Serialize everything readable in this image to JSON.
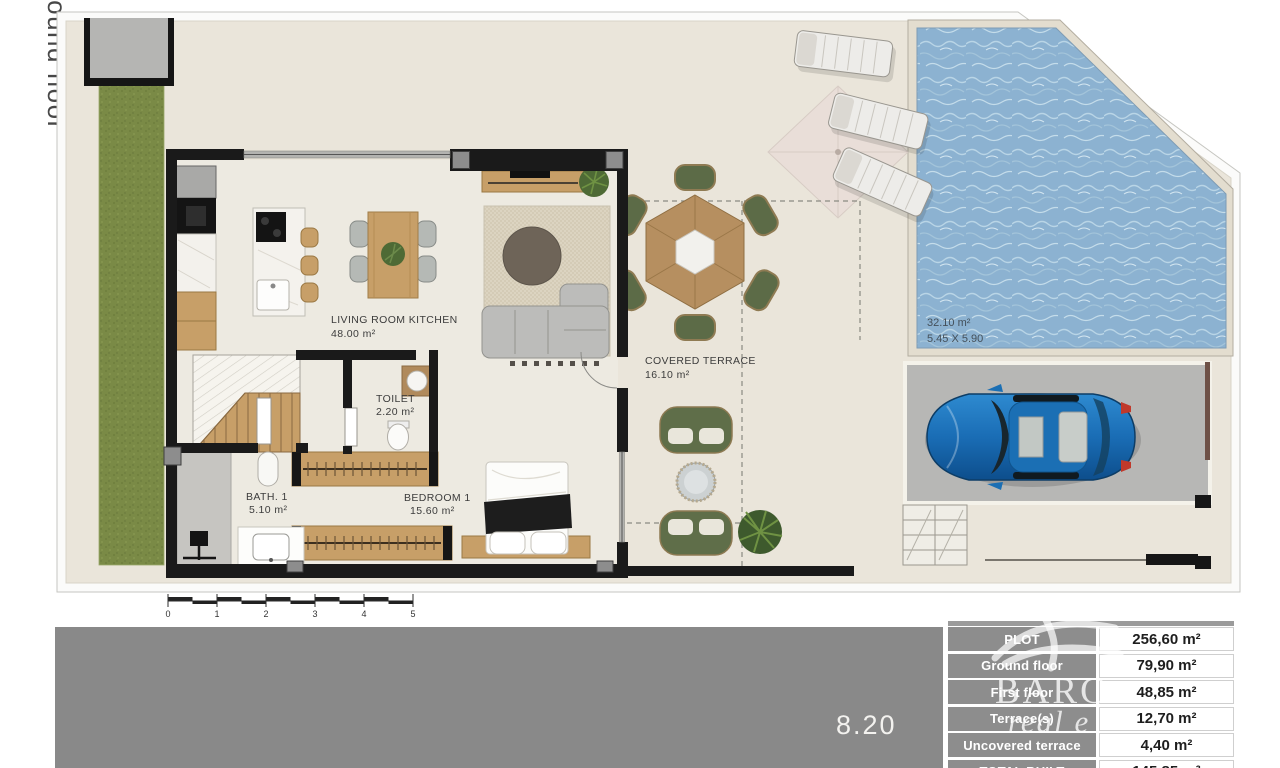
{
  "floor": {
    "label": "ground floor"
  },
  "plan_labels": {
    "living": {
      "name": "LIVING ROOM KITCHEN",
      "area": "48.00 m²"
    },
    "toilet": {
      "name": "TOILET",
      "area": "2.20 m²"
    },
    "bath": {
      "name": "BATH. 1",
      "area": "5.10 m²"
    },
    "bedroom": {
      "name": "BEDROOM 1",
      "area": "15.60 m²"
    },
    "covered_terrace": {
      "name": "COVERED TERRACE",
      "area": "16.10 m²"
    },
    "pool": {
      "area": "32.10 m²",
      "size": "5.45 X 5.90"
    }
  },
  "scale_bar": {
    "ticks": [
      "0",
      "1",
      "2",
      "3",
      "4",
      "5"
    ]
  },
  "dimension": {
    "plot_width": "8.20"
  },
  "areas_table": {
    "rows": [
      {
        "label": "PLOT",
        "value": "256,60 m²"
      },
      {
        "label": "Ground floor",
        "value": "79,90 m²"
      },
      {
        "label": "First floor",
        "value": "48,85 m²"
      },
      {
        "label": "Terrace(s)",
        "value": "12,70 m²"
      },
      {
        "label": "Uncovered terrace",
        "value": "4,40 m²"
      },
      {
        "label": "TOTAL BUILT",
        "value": "145,85 m²"
      }
    ]
  },
  "watermark": {
    "line1": "BARC",
    "line2": "real e"
  },
  "colors": {
    "ground": "#eae5da",
    "grass": "#7a8a46",
    "pool_water": "#8cb2d1",
    "wall": "#1a1a1a",
    "wood": "#c79f68",
    "terrace_green": "#5f6e49",
    "band_gray": "#898989",
    "table_label_bg": "#8d8d8d",
    "car_blue": "#1a6db5"
  }
}
